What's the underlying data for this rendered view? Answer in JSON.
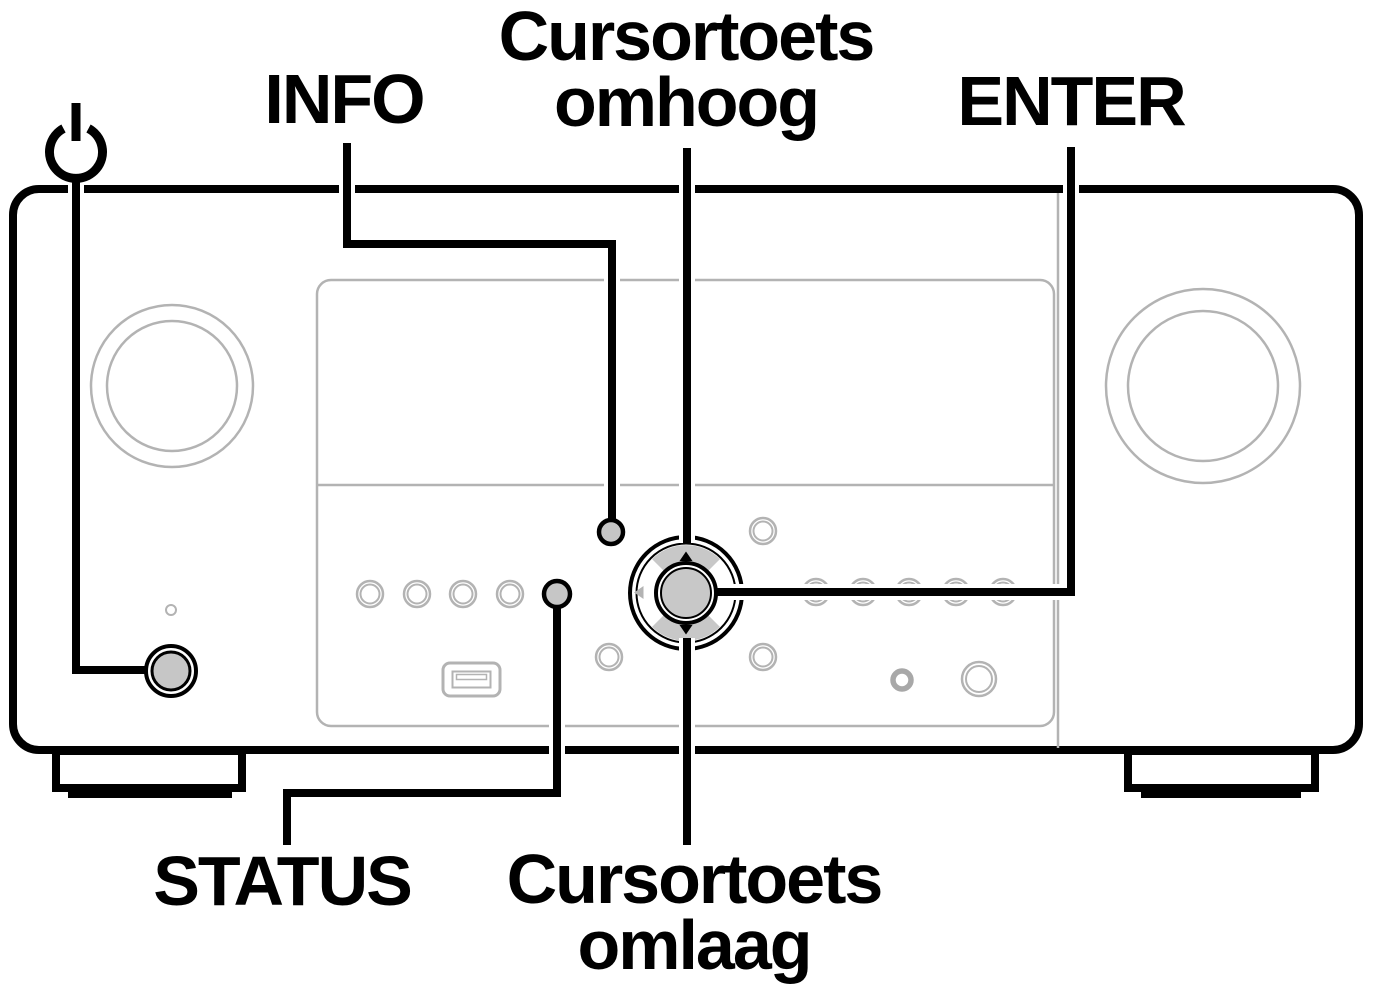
{
  "figure": {
    "labels": {
      "info": "INFO",
      "enter": "ENTER",
      "status": "STATUS",
      "cursor_up": {
        "line1": "Cursortoets",
        "line2": "omhoog"
      },
      "cursor_down": {
        "line1": "Cursortoets",
        "line2": "omlaag"
      }
    },
    "icons": {
      "power": "power-icon",
      "cursor_up_arrow": "triangle-up",
      "cursor_down_arrow": "triangle-down",
      "cursor_left_arrow": "triangle-left"
    },
    "colors": {
      "callout_line": "#000000",
      "panel_border": "#000000",
      "panel_detail_outline": "#b3b3b3",
      "button_fill": "#c6c6c6",
      "background": "#ffffff"
    }
  }
}
